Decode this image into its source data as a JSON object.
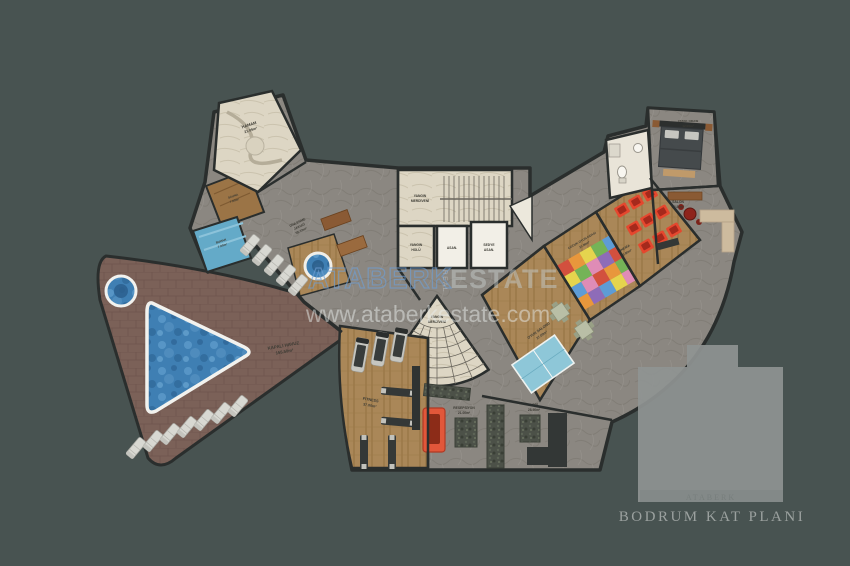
{
  "watermark": {
    "brand_primary": "ATABERK",
    "brand_secondary": "ESTATE",
    "brand_vertical": "REAL",
    "website": "www.ataberkestate.com"
  },
  "title_block": {
    "plan_title": "BODRUM KAT PLANI",
    "logo_caption": "ATABERK"
  },
  "labels": {
    "hamam": {
      "name": "HAMAM",
      "area": "21.09m²"
    },
    "sauna": {
      "name": "SAUNA",
      "area": "7.00m²"
    },
    "buhar": {
      "name": "BUHAR",
      "area": "7.00m²"
    },
    "dinlenme": {
      "name": "DİNLENME",
      "sub": "JAKUZİ",
      "area": "55.10m²"
    },
    "kapali_havuz": {
      "name": "KAPALI HAVUZ",
      "area": "155.50m²"
    },
    "fire_top": {
      "line1": "YANGIN",
      "line2": "MERDİVENİ"
    },
    "fire_hall": {
      "line1": "YANGIN",
      "line2": "HOLÜ"
    },
    "elevator": {
      "name": "ASAN."
    },
    "stretcher": {
      "line1": "SEDYE",
      "line2": "ASAN."
    },
    "fire_bottom": {
      "line1": "YANGIN",
      "line2": "MERDİVENİ"
    },
    "fitness": {
      "name": "FITNESS",
      "area": "37.00m²"
    },
    "resepsiyon": {
      "name": "RESEPSİYON",
      "area": "21.00m²"
    },
    "lobi": {
      "name": "LOBİ",
      "area": "28.90m²"
    },
    "oyun_salonu": {
      "name": "OYUN SALONU",
      "area": "37.00m²"
    },
    "cocuk_oyun": {
      "name": "ÇOCUK OYUN ODASI",
      "area": "21.00m²"
    },
    "sinema": {
      "name": "SİNEMA",
      "area": "20.80m²"
    },
    "yatak_odasi": {
      "name": "YATAK ODASI",
      "area": "12.00m²"
    },
    "salon": {
      "name": "SALON",
      "area": "22.80m²"
    }
  },
  "colors": {
    "background": "#485351",
    "wall": "#2a2e2d",
    "stone_floor": "#8b8781",
    "marble_floor": "#ddd6c4",
    "wood_floor": "#aa8758",
    "pool_water": "#3f7fb3",
    "deck": "#7b6158",
    "sauna_wood": "#9b7446",
    "steam_blue": "#64aac8",
    "cinema_seat": "#e5472e",
    "reception_desk": "#e2573a",
    "pingpong_table": "#8ec7d8",
    "watermark_blue": "#6f9fd4"
  }
}
